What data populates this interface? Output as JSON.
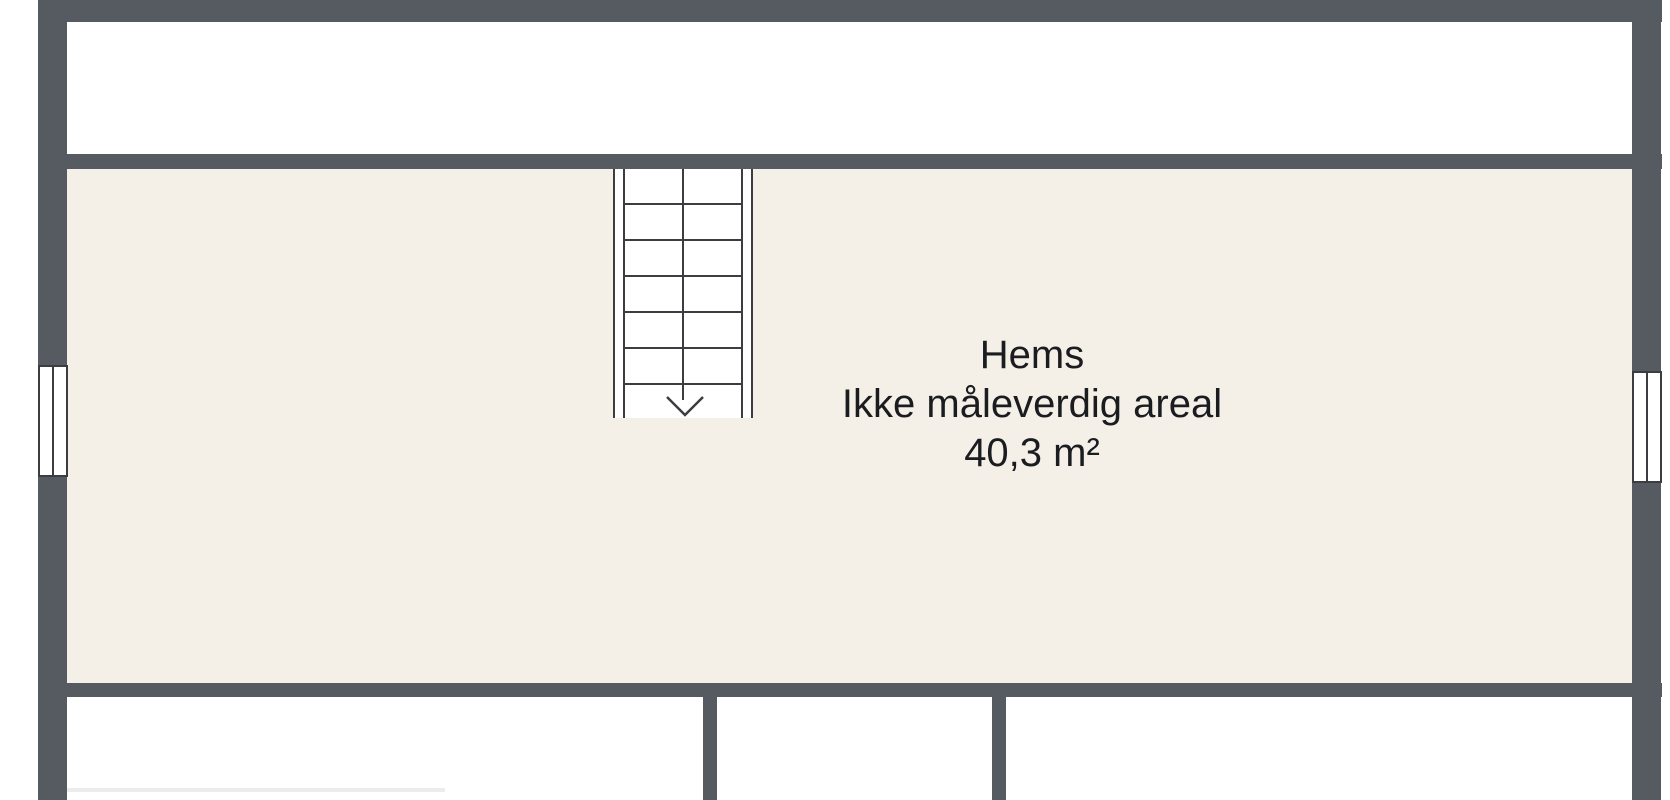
{
  "floorplan": {
    "room": {
      "name": "Hems",
      "note": "Ikke måleverdig areal",
      "area": "40,3 m²"
    },
    "stairs": {
      "tread_count": 6,
      "direction": "down",
      "arrow_icon": "arrow-down"
    },
    "windows": [
      "window-left",
      "window-right"
    ],
    "colors": {
      "wall": "#565a61",
      "room_fill": "#f5f0e7",
      "adjacent_fill": "#ffffff",
      "line": "#3b3d41",
      "text": "#1a1c20"
    }
  }
}
